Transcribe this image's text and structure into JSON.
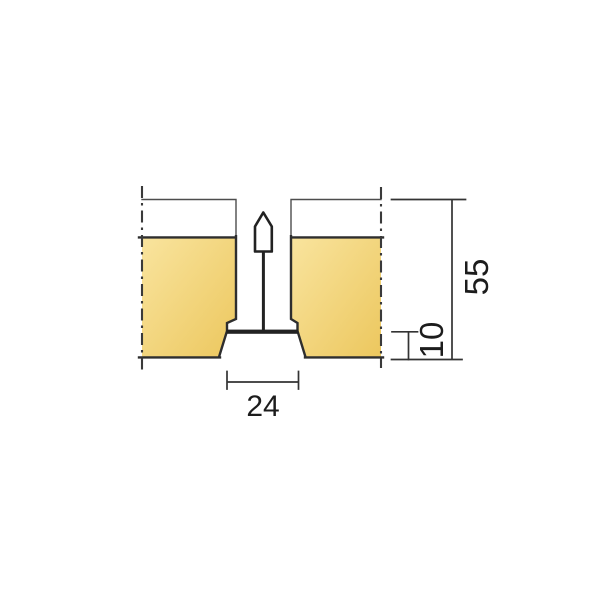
{
  "diagram": {
    "dimensions": {
      "grid_width_label": "24",
      "edge_height_label": "10",
      "total_height_label": "55"
    },
    "colors": {
      "background": "#ffffff",
      "tile_gradient_light": "#f9e49e",
      "tile_gradient_dark": "#ecc75e",
      "tile_face_white": "#ffffff",
      "profile_dark": "#222222",
      "outline": "#2e2e2e",
      "centerline": "#3a3a3a",
      "dimension_line": "#333333",
      "text": "#1c1c1c"
    }
  }
}
